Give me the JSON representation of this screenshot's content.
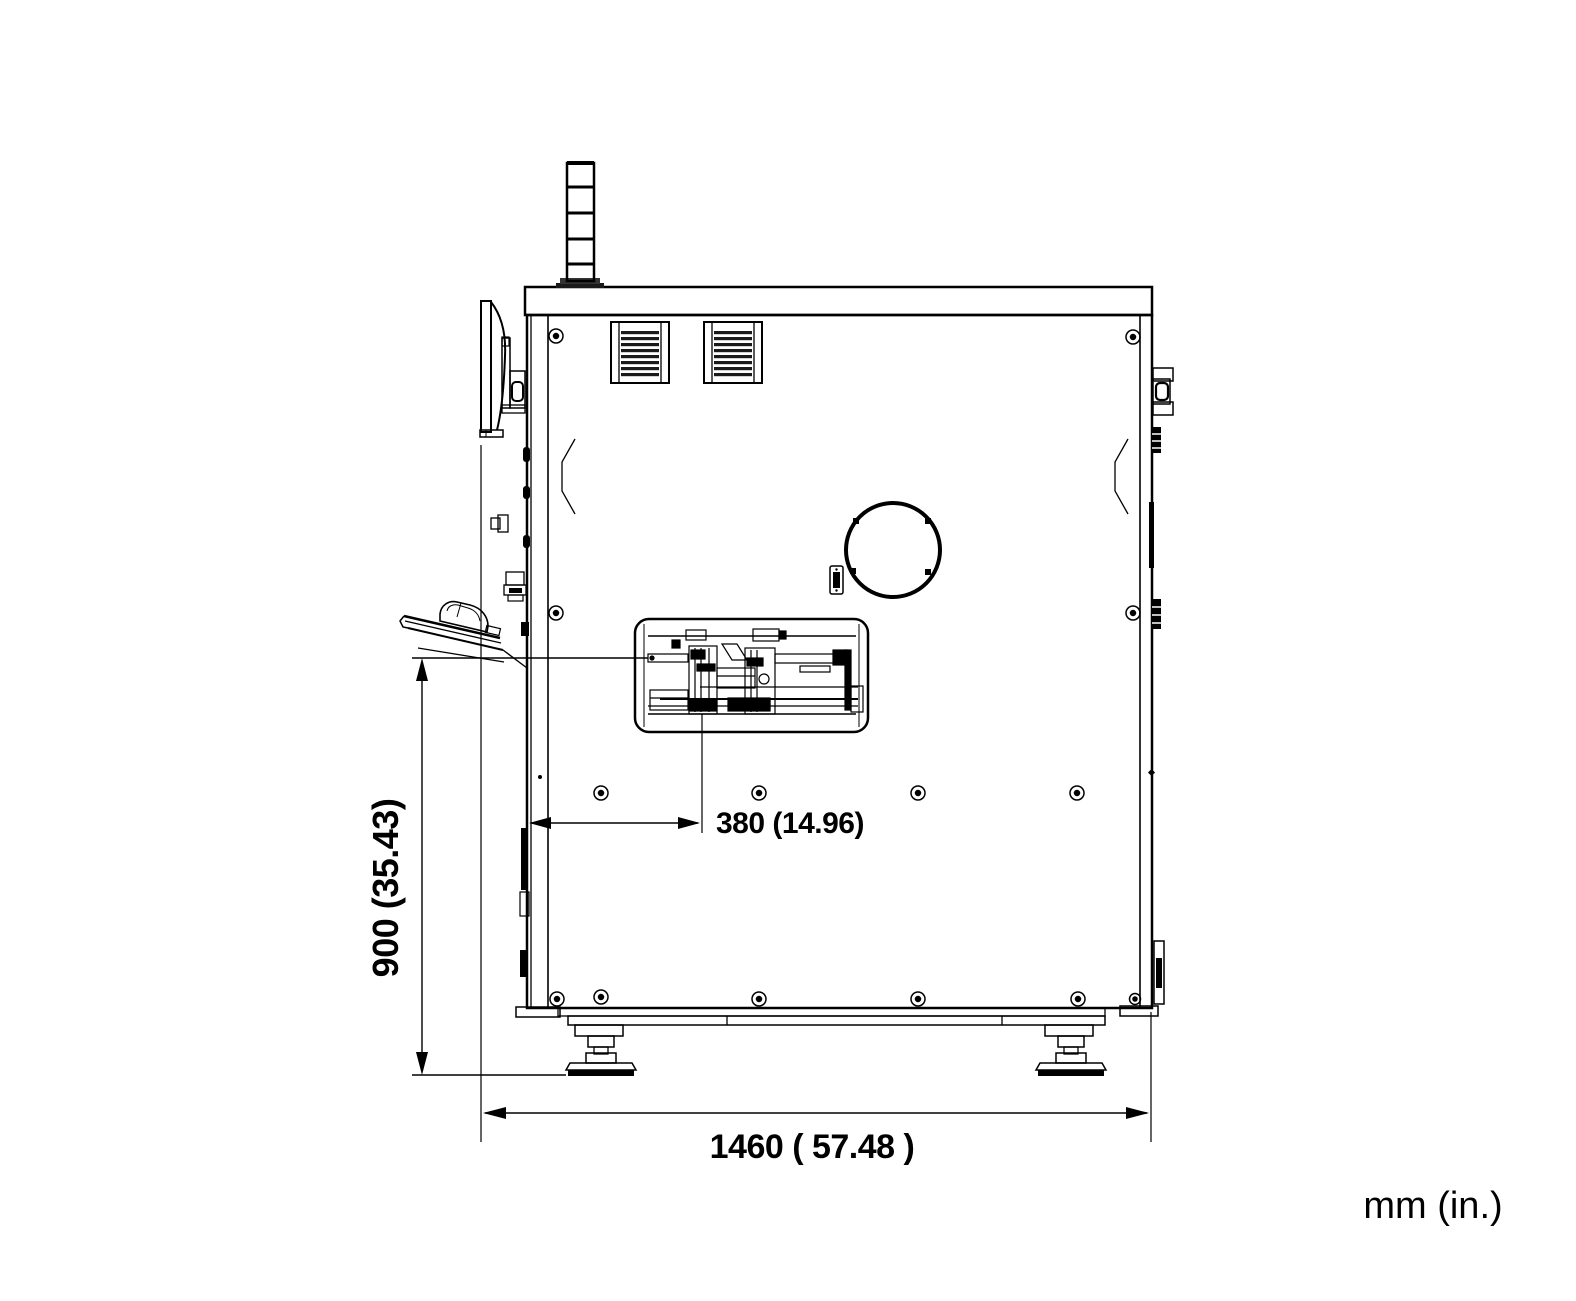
{
  "drawing": {
    "units_note": "mm (in.)",
    "background_color": "#ffffff",
    "line_color": "#000000",
    "dimensions": {
      "overall_width": {
        "label": "1460 ( 57.48 )",
        "mm": "1460",
        "in": "57.48"
      },
      "work_height": {
        "label": "900 (35.43)",
        "mm": "900",
        "in": "35.43"
      },
      "mechanism_offset": {
        "label": "380 (14.96)",
        "mm": "380",
        "in": "14.96"
      }
    }
  }
}
